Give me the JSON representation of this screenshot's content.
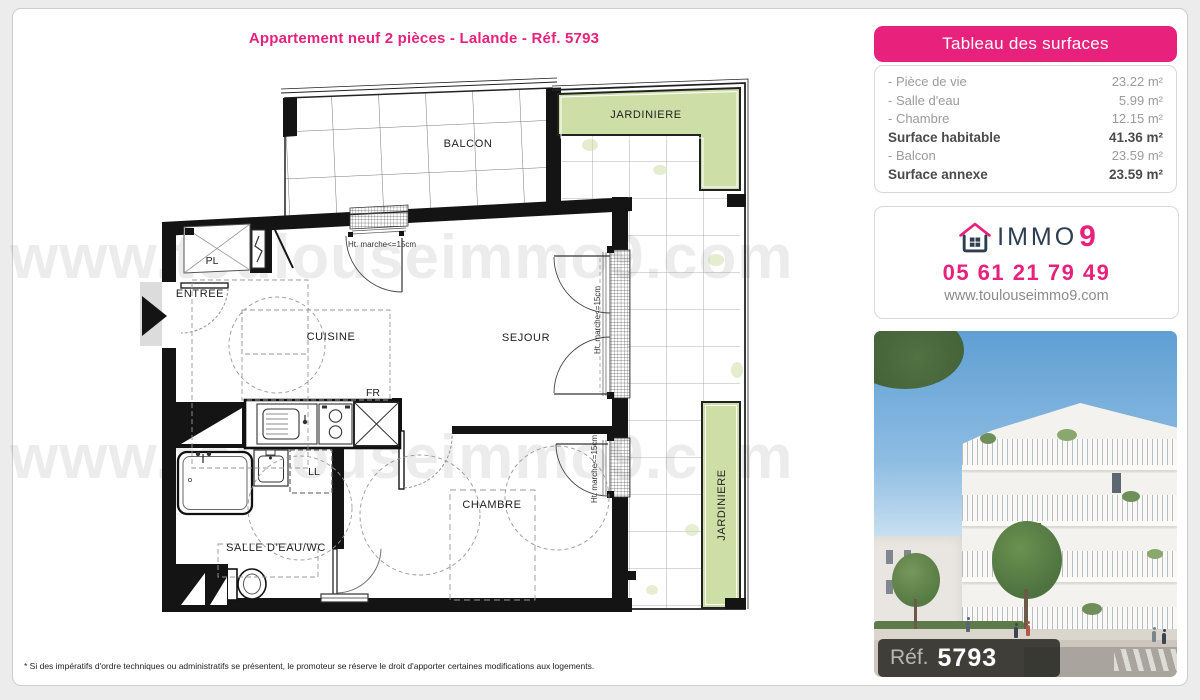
{
  "page": {
    "title": "Appartement neuf 2 pièces - Lalande - Réf. 5793",
    "watermark": "www.toulouseimmo9.com",
    "footnote": "* Si des impératifs d'ordre techniques ou administratifs se présentent, le promoteur se réserve le droit d'apporter certaines modifications aux logements."
  },
  "surfaces": {
    "header": "Tableau des surfaces",
    "rows": [
      {
        "label": "- Pièce de vie",
        "value": "23.22 m²"
      },
      {
        "label": "- Salle d'eau",
        "value": "5.99 m²"
      },
      {
        "label": "- Chambre",
        "value": "12.15 m²"
      },
      {
        "label": "Surface habitable",
        "value": "41.36 m²"
      },
      {
        "label": "- Balcon",
        "value": "23.59 m²"
      },
      {
        "label": "Surface annexe",
        "value": "23.59 m²"
      }
    ]
  },
  "agency": {
    "brand": "IMMO",
    "brand_number": "9",
    "phone": "05 61 21 79 49",
    "website": "www.toulouseimmo9.com"
  },
  "photo": {
    "ref_label": "Réf.",
    "ref_number": "5793"
  },
  "plan": {
    "rooms": {
      "balcon": "BALCON",
      "jardiniere_top": "JARDINIERE",
      "jardiniere_right": "JARDINIERE",
      "pl": "PL",
      "entree": "ENTREE",
      "cuisine": "CUISINE",
      "fr": "FR",
      "sejour": "SEJOUR",
      "ll": "LL",
      "salle_deau": "SALLE D'EAU/WC",
      "chambre": "CHAMBRE"
    },
    "annotations": {
      "step_note": "Ht. marche<=15cm"
    }
  },
  "colors": {
    "accent": "#e8217c",
    "plan_green": "#cddfa6",
    "navy": "#2d3e50"
  }
}
